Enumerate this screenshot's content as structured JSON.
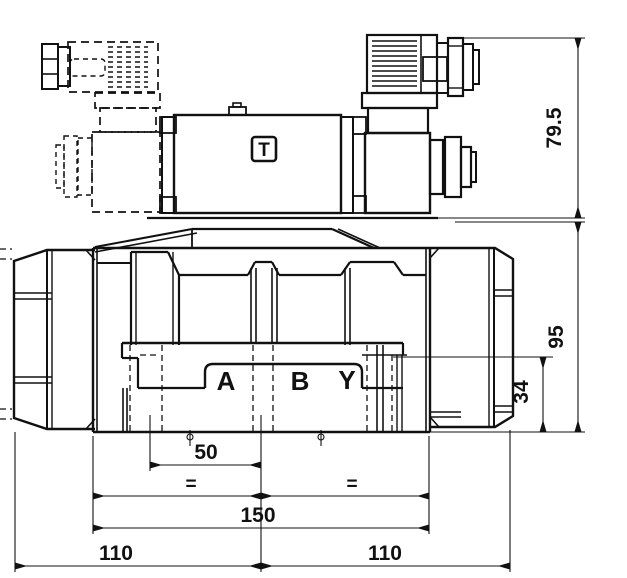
{
  "labels": {
    "solenoid_type": "T",
    "port_a": "A",
    "port_b": "B",
    "port_y": "Y"
  },
  "dimensions": {
    "solenoid_height": "79.5",
    "body_height": "95",
    "port_face_height": "34",
    "port_spacing": "50",
    "subplate_width": "150",
    "left_width": "110",
    "right_width": "110",
    "equal_left": "=",
    "equal_right": "="
  },
  "colors": {
    "line": "#111111",
    "background": "#ffffff"
  }
}
